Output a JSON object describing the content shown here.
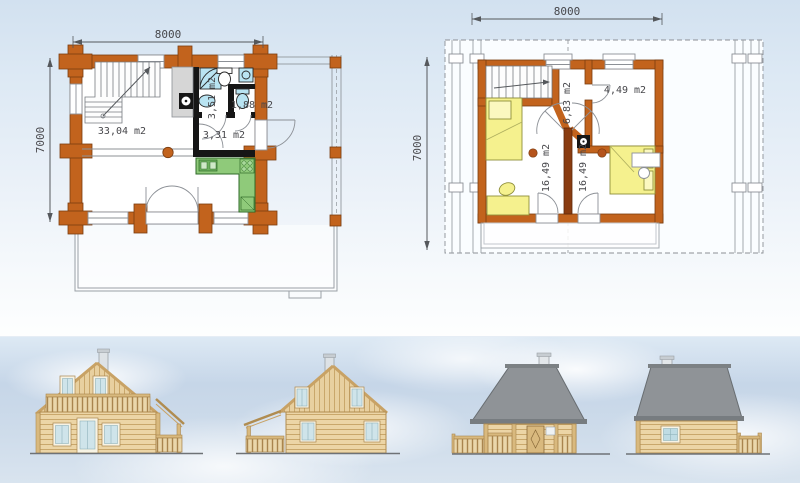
{
  "ground_floor": {
    "dim_width": "8000",
    "dim_depth": "7000",
    "labels": {
      "living_room": "33,04 m2",
      "bathroom": "3,51 m2",
      "wc": "1,88 m2",
      "hall": "3,31 m2"
    }
  },
  "upper_floor": {
    "dim_width": "8000",
    "dim_depth": "7000",
    "labels": {
      "hall": "6,83 m2",
      "bathroom": "4,49 m2",
      "bedroom_left": "16,49 m2",
      "bedroom_right": "16,49 m2"
    }
  },
  "colors": {
    "plan_wall": "#c2631d",
    "plan_wall_dark": "#7a3c10",
    "interior_wall_black": "#161616",
    "kitchen_green": "#8fca7a",
    "furniture_yellow": "#f5f18e",
    "fixture_blue": "#b9e4f2",
    "roof_gray": "#8f9397",
    "timber_light": "#ecd5a6",
    "sky_band_blue": "#c9d8e9"
  }
}
